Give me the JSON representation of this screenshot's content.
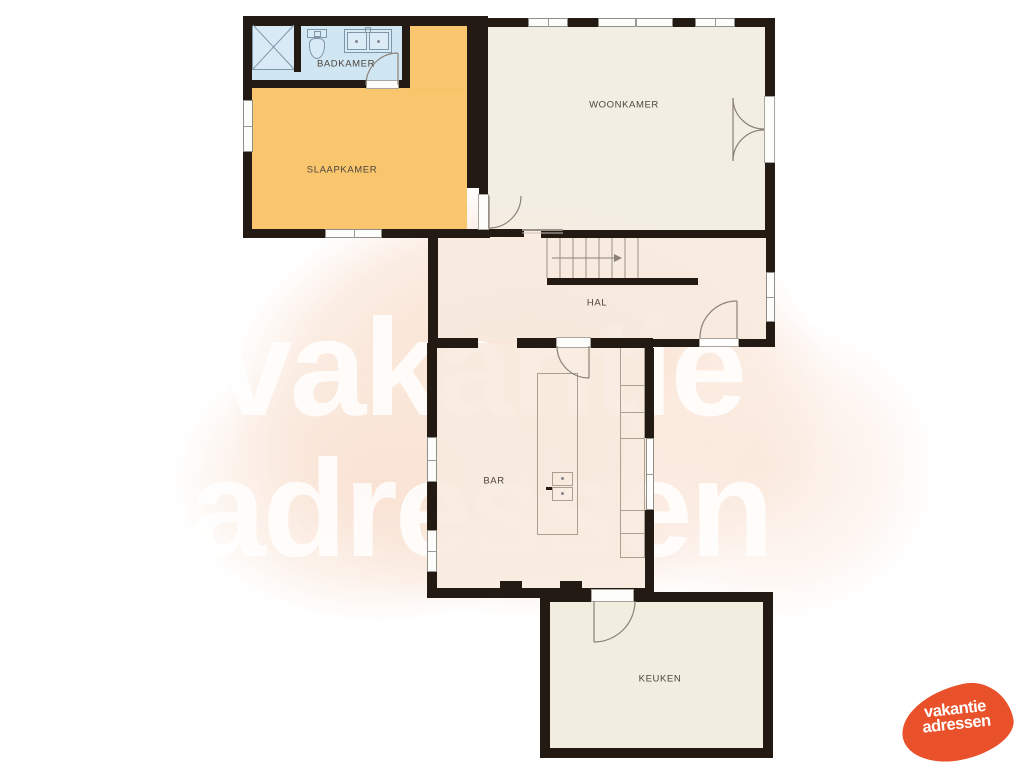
{
  "plan_title": "floorplan",
  "watermark": {
    "line1": "vakantie",
    "line2": "adressen"
  },
  "logo": {
    "line1": "vakantie",
    "line2": "adressen",
    "color": "#e8512a"
  },
  "rooms": {
    "badkamer": {
      "label": "BADKAMER",
      "color": "#cde4f2"
    },
    "slaapkamer": {
      "label": "SLAAPKAMER",
      "color": "#f9c366"
    },
    "woonkamer": {
      "label": "WOONKAMER",
      "color": "#f2ece1"
    },
    "hal": {
      "label": "HAL",
      "color": "#f7e9de"
    },
    "bar": {
      "label": "BAR",
      "color": "#f8eadf"
    },
    "keuken": {
      "label": "KEUKEN",
      "color": "#f1ecdb"
    }
  },
  "colors": {
    "wall": "#231a14",
    "label_text": "#4b453e",
    "watermark_blob": "#f9e3d3",
    "window_frame": "#8f8f89"
  },
  "fixtures": {
    "bathroom": [
      "shower",
      "toilet",
      "double-sink"
    ],
    "bar": [
      "island-counter",
      "island-sink",
      "cabinet-column"
    ],
    "stairs": {
      "location": "hal",
      "direction_arrow": "right"
    }
  }
}
